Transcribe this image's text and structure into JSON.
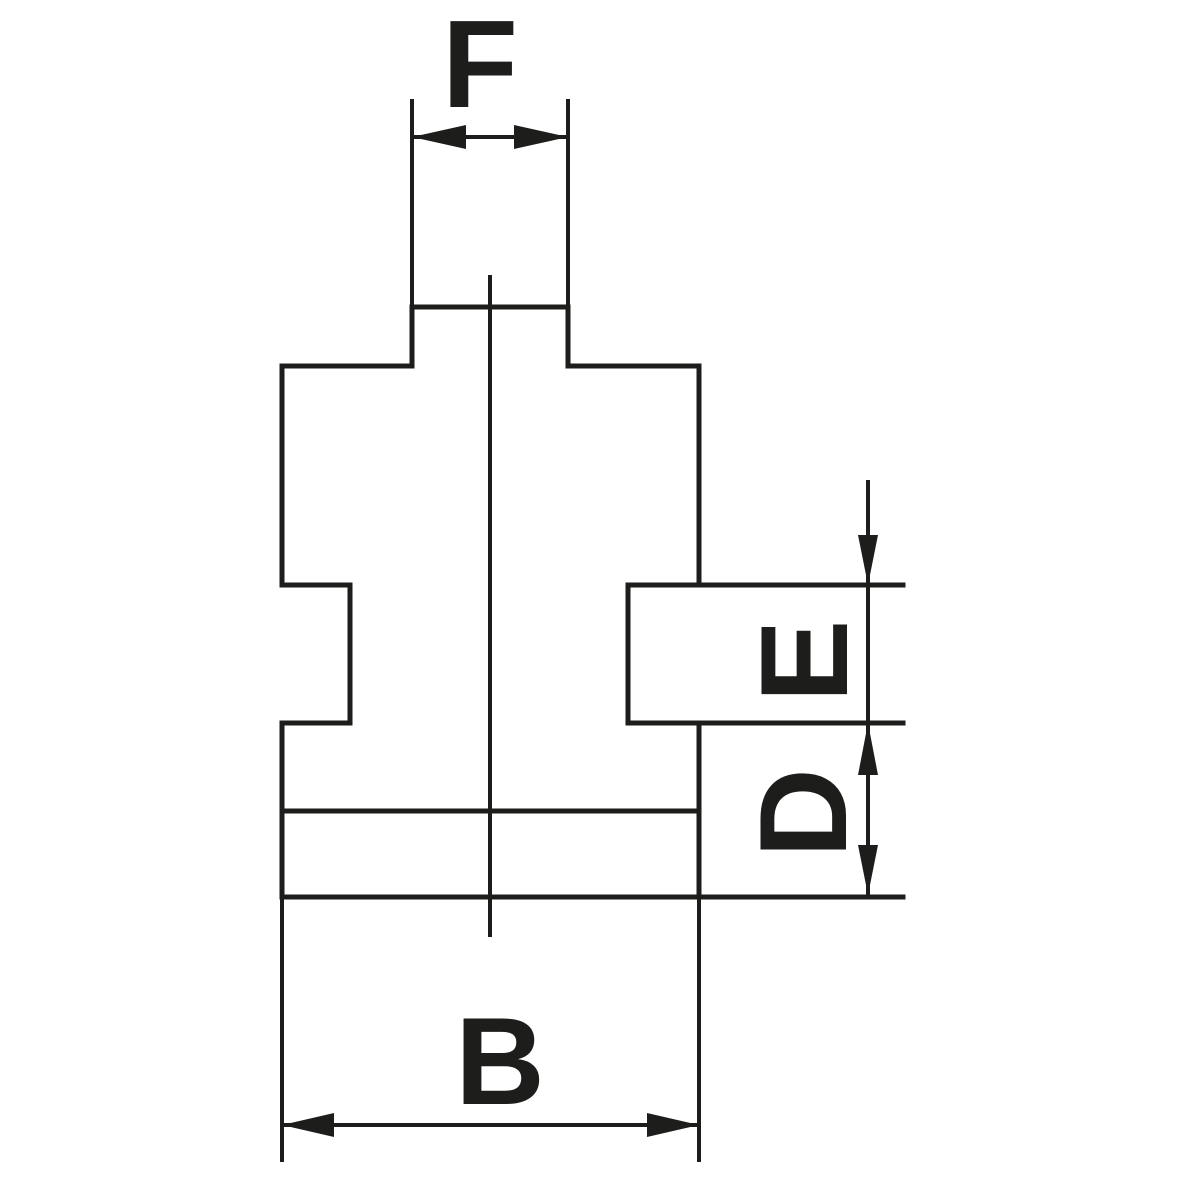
{
  "drawing": {
    "description": "Technical cross-section line drawing of a lathe chuck jaw profile with dimension callouts",
    "background_color": "#ffffff",
    "line_color": "#1d1d1b",
    "dimensions": [
      {
        "id": "F",
        "label": "F",
        "orientation": "horizontal",
        "position": "top",
        "measures": "width of narrow top boss between extension lines"
      },
      {
        "id": "E",
        "label": "E",
        "orientation": "vertical",
        "position": "right",
        "measures": "height of side guide tongue (between tongue top and bottom edges)"
      },
      {
        "id": "D",
        "label": "D",
        "orientation": "vertical",
        "position": "right",
        "measures": "distance from tongue bottom edge to jaw bottom face"
      },
      {
        "id": "B",
        "label": "B",
        "orientation": "horizontal",
        "position": "bottom",
        "measures": "overall jaw body width"
      }
    ]
  }
}
